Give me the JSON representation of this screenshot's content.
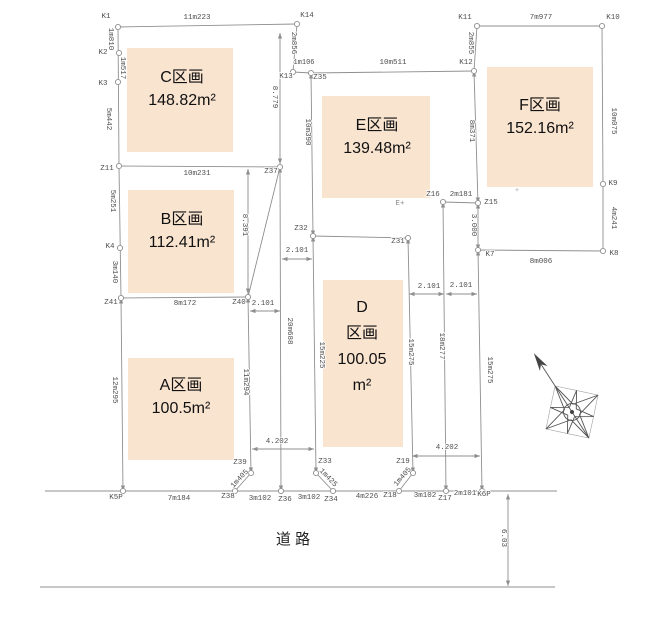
{
  "canvas": {
    "width": 660,
    "height": 621,
    "bg": "#ffffff",
    "line_color": "#8f8f8f",
    "label_color": "#4d4d4d",
    "parcel_fill": "#f9e4d0",
    "parcel_text_color": "#111111"
  },
  "parcels": [
    {
      "name": "parcel-c",
      "rect": [
        127,
        48,
        106,
        104
      ],
      "cx": 182,
      "ty": 82,
      "gap": 23,
      "fs": 16,
      "lines": [
        "C区画",
        "148.82m²"
      ]
    },
    {
      "name": "parcel-b",
      "rect": [
        128,
        190,
        106,
        103
      ],
      "cx": 182,
      "ty": 224,
      "gap": 23,
      "fs": 16,
      "lines": [
        "B区画",
        "112.41m²"
      ]
    },
    {
      "name": "parcel-a",
      "rect": [
        128,
        358,
        106,
        102
      ],
      "cx": 181,
      "ty": 390,
      "gap": 23,
      "fs": 16,
      "lines": [
        "A区画",
        "100.5m²"
      ]
    },
    {
      "name": "parcel-e",
      "rect": [
        322,
        96,
        108,
        102
      ],
      "cx": 377,
      "ty": 130,
      "gap": 23,
      "fs": 16,
      "lines": [
        "E区画",
        "139.48m²"
      ]
    },
    {
      "name": "parcel-d",
      "rect": [
        323,
        280,
        80,
        167
      ],
      "cx": 362,
      "ty": 312,
      "gap": 26,
      "fs": 16,
      "lines": [
        "D",
        "区画",
        "100.05",
        "m²"
      ]
    },
    {
      "name": "parcel-f",
      "rect": [
        487,
        67,
        106,
        120
      ],
      "cx": 540,
      "ty": 110,
      "gap": 23,
      "fs": 16,
      "lines": [
        "F区画",
        "152.16m²"
      ]
    }
  ],
  "lines": [
    [
      118,
      27,
      297,
      24,
      0
    ],
    [
      297,
      24,
      293,
      72,
      0
    ],
    [
      293,
      72,
      311,
      73,
      0
    ],
    [
      311,
      73,
      474,
      71,
      0
    ],
    [
      477,
      26,
      602,
      26,
      0
    ],
    [
      477,
      26,
      474,
      71,
      0
    ],
    [
      602,
      26,
      603,
      184,
      0
    ],
    [
      603,
      184,
      603,
      251,
      0
    ],
    [
      478,
      250,
      603,
      251,
      0
    ],
    [
      118,
      27,
      119,
      166,
      0
    ],
    [
      119,
      166,
      280,
      167,
      0
    ],
    [
      119,
      166,
      121,
      298,
      0
    ],
    [
      121,
      298,
      248,
      297,
      0
    ],
    [
      280,
      167,
      248,
      297,
      0
    ],
    [
      121,
      298,
      123,
      491,
      1
    ],
    [
      45,
      491,
      557,
      491,
      0
    ],
    [
      40,
      587,
      555,
      587,
      0
    ],
    [
      251,
      473,
      235,
      491,
      0
    ],
    [
      316,
      473,
      333,
      491,
      0
    ],
    [
      413,
      473,
      399,
      491,
      0
    ],
    [
      313,
      236,
      408,
      238,
      0
    ],
    [
      443,
      202,
      478,
      203,
      0
    ],
    [
      280,
      33,
      280,
      164,
      1
    ],
    [
      248,
      169,
      248,
      294,
      1
    ],
    [
      280,
      167,
      281,
      491,
      1
    ],
    [
      311,
      73,
      313,
      236,
      1
    ],
    [
      313,
      236,
      316,
      473,
      1
    ],
    [
      408,
      238,
      413,
      473,
      1
    ],
    [
      443,
      202,
      446,
      491,
      1
    ],
    [
      478,
      250,
      482,
      491,
      1
    ],
    [
      474,
      71,
      478,
      203,
      1
    ],
    [
      478,
      203,
      478,
      250,
      1
    ],
    [
      248,
      297,
      251,
      473,
      1
    ],
    [
      282,
      259,
      312,
      259,
      1
    ],
    [
      250,
      311,
      280,
      311,
      1
    ],
    [
      409,
      294,
      444,
      294,
      1
    ],
    [
      446,
      294,
      477,
      294,
      1
    ],
    [
      252,
      449,
      314,
      449,
      1
    ],
    [
      412,
      456,
      480,
      456,
      1
    ],
    [
      508,
      494,
      508,
      586,
      1
    ]
  ],
  "points": [
    [
      118,
      27
    ],
    [
      119,
      53
    ],
    [
      118,
      82
    ],
    [
      119,
      166
    ],
    [
      120,
      248
    ],
    [
      121,
      298
    ],
    [
      123,
      491
    ],
    [
      297,
      24
    ],
    [
      293,
      72
    ],
    [
      311,
      73
    ],
    [
      474,
      71
    ],
    [
      477,
      26
    ],
    [
      602,
      26
    ],
    [
      603,
      184
    ],
    [
      603,
      251
    ],
    [
      478,
      250
    ],
    [
      478,
      203
    ],
    [
      443,
      202
    ],
    [
      280,
      167
    ],
    [
      248,
      297
    ],
    [
      251,
      473
    ],
    [
      235,
      491
    ],
    [
      281,
      491
    ],
    [
      333,
      491
    ],
    [
      316,
      473
    ],
    [
      313,
      236
    ],
    [
      408,
      238
    ],
    [
      413,
      473
    ],
    [
      399,
      491
    ],
    [
      446,
      491
    ],
    [
      482,
      491
    ]
  ],
  "labels": [
    {
      "t": "K1",
      "x": 106,
      "y": 18,
      "n": "point-label"
    },
    {
      "t": "K2",
      "x": 103,
      "y": 54,
      "n": "point-label"
    },
    {
      "t": "K3",
      "x": 103,
      "y": 85,
      "n": "point-label"
    },
    {
      "t": "Z11",
      "x": 107,
      "y": 170,
      "n": "point-label"
    },
    {
      "t": "K4",
      "x": 110,
      "y": 248,
      "n": "point-label"
    },
    {
      "t": "Z41",
      "x": 111,
      "y": 304,
      "n": "point-label"
    },
    {
      "t": "K5P",
      "x": 116,
      "y": 499,
      "n": "point-label"
    },
    {
      "t": "K14",
      "x": 307,
      "y": 17,
      "n": "point-label"
    },
    {
      "t": "K13",
      "x": 286,
      "y": 78,
      "n": "point-label"
    },
    {
      "t": "Z35",
      "x": 320,
      "y": 79,
      "n": "point-label"
    },
    {
      "t": "K12",
      "x": 466,
      "y": 64,
      "n": "point-label"
    },
    {
      "t": "K11",
      "x": 465,
      "y": 19,
      "n": "point-label"
    },
    {
      "t": "K10",
      "x": 613,
      "y": 19,
      "n": "point-label"
    },
    {
      "t": "K9",
      "x": 613,
      "y": 185,
      "n": "point-label"
    },
    {
      "t": "K8",
      "x": 614,
      "y": 255,
      "n": "point-label"
    },
    {
      "t": "K7",
      "x": 490,
      "y": 256,
      "n": "point-label"
    },
    {
      "t": "Z15",
      "x": 491,
      "y": 204,
      "n": "point-label"
    },
    {
      "t": "Z16",
      "x": 433,
      "y": 196,
      "n": "point-label"
    },
    {
      "t": "Z37",
      "x": 271,
      "y": 173,
      "n": "point-label"
    },
    {
      "t": "Z40",
      "x": 239,
      "y": 304,
      "n": "point-label"
    },
    {
      "t": "Z39",
      "x": 240,
      "y": 464,
      "n": "point-label"
    },
    {
      "t": "Z38",
      "x": 228,
      "y": 498,
      "n": "point-label"
    },
    {
      "t": "Z36",
      "x": 285,
      "y": 501,
      "n": "point-label"
    },
    {
      "t": "Z34",
      "x": 331,
      "y": 501,
      "n": "point-label"
    },
    {
      "t": "Z33",
      "x": 325,
      "y": 463,
      "n": "point-label"
    },
    {
      "t": "Z32",
      "x": 301,
      "y": 230,
      "n": "point-label"
    },
    {
      "t": "Z31",
      "x": 398,
      "y": 243,
      "n": "point-label"
    },
    {
      "t": "Z19",
      "x": 403,
      "y": 463,
      "n": "point-label"
    },
    {
      "t": "Z18",
      "x": 390,
      "y": 497,
      "n": "point-label"
    },
    {
      "t": "Z17",
      "x": 445,
      "y": 500,
      "n": "point-label"
    },
    {
      "t": "K6P",
      "x": 484,
      "y": 496,
      "n": "point-label"
    },
    {
      "t": "11m223",
      "x": 197,
      "y": 19
    },
    {
      "t": "1m106",
      "x": 304,
      "y": 64,
      "s": 7
    },
    {
      "t": "10m511",
      "x": 393,
      "y": 64
    },
    {
      "t": "7m977",
      "x": 541,
      "y": 19
    },
    {
      "t": "2m181",
      "x": 461,
      "y": 196
    },
    {
      "t": "10m231",
      "x": 197,
      "y": 175
    },
    {
      "t": "8m172",
      "x": 185,
      "y": 305
    },
    {
      "t": "8m006",
      "x": 541,
      "y": 263
    },
    {
      "t": "7m184",
      "x": 179,
      "y": 500
    },
    {
      "t": "3m102",
      "x": 260,
      "y": 500
    },
    {
      "t": "3m102",
      "x": 309,
      "y": 499
    },
    {
      "t": "4m226",
      "x": 367,
      "y": 498
    },
    {
      "t": "3m102",
      "x": 425,
      "y": 497
    },
    {
      "t": "2m101",
      "x": 465,
      "y": 495
    },
    {
      "t": "1m810",
      "x": 109,
      "y": 39,
      "r": 90
    },
    {
      "t": "1m517",
      "x": 121,
      "y": 68,
      "r": 90
    },
    {
      "t": "5m442",
      "x": 107,
      "y": 119,
      "r": 90
    },
    {
      "t": "5m251",
      "x": 111,
      "y": 201,
      "r": 90
    },
    {
      "t": "3m140",
      "x": 113,
      "y": 272,
      "r": 90
    },
    {
      "t": "12m295",
      "x": 113,
      "y": 390,
      "r": 90
    },
    {
      "t": "2m856",
      "x": 292,
      "y": 43,
      "r": 90
    },
    {
      "t": "2m855",
      "x": 469,
      "y": 43,
      "r": 90
    },
    {
      "t": "8m371",
      "x": 470,
      "y": 131,
      "r": 90
    },
    {
      "t": "10m075",
      "x": 612,
      "y": 121,
      "r": 90
    },
    {
      "t": "4m241",
      "x": 612,
      "y": 218,
      "r": 90
    },
    {
      "t": "10m390",
      "x": 306,
      "y": 132,
      "r": 90
    },
    {
      "t": "15m225",
      "x": 320,
      "y": 355,
      "r": 90
    },
    {
      "t": "20m688",
      "x": 288,
      "y": 331,
      "r": 90
    },
    {
      "t": "15m275",
      "x": 409,
      "y": 352,
      "r": 90
    },
    {
      "t": "18m277",
      "x": 440,
      "y": 346,
      "r": 90
    },
    {
      "t": "15m275",
      "x": 488,
      "y": 370,
      "r": 90
    },
    {
      "t": "11m294",
      "x": 244,
      "y": 382,
      "r": 90
    },
    {
      "t": "8.779",
      "x": 273,
      "y": 97,
      "r": 90
    },
    {
      "t": "8.391",
      "x": 243,
      "y": 225,
      "r": 90
    },
    {
      "t": "3.000",
      "x": 472,
      "y": 225,
      "r": 90
    },
    {
      "t": "6.03",
      "x": 502,
      "y": 538,
      "r": 90
    },
    {
      "t": "1m425",
      "x": 327,
      "y": 479,
      "r": 46
    },
    {
      "t": "1m405",
      "x": 241,
      "y": 480,
      "r": -47
    },
    {
      "t": "1m405",
      "x": 404,
      "y": 478,
      "r": -49
    },
    {
      "t": "2.101",
      "x": 297,
      "y": 252
    },
    {
      "t": "2.101",
      "x": 263,
      "y": 305
    },
    {
      "t": "2.101",
      "x": 429,
      "y": 288
    },
    {
      "t": "2.101",
      "x": 461,
      "y": 287
    },
    {
      "t": "4.202",
      "x": 277,
      "y": 443
    },
    {
      "t": "4.202",
      "x": 447,
      "y": 449
    },
    {
      "t": "E+",
      "x": 400,
      "y": 205,
      "c": "#888888",
      "n": "e-point-marker"
    },
    {
      "t": "+",
      "x": 517,
      "y": 192,
      "c": "#b5b5b5",
      "n": "f-point-marker"
    },
    {
      "t": "道 路",
      "x": 293,
      "y": 544,
      "s": 15,
      "c": "#222222",
      "f": "sans",
      "n": "road-label"
    }
  ]
}
